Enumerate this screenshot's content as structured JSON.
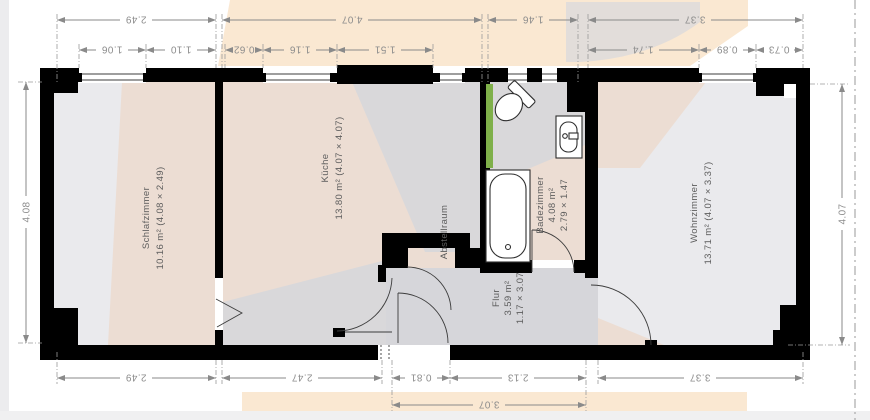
{
  "rooms": {
    "schlafzimmer": {
      "name": "Schlafzimmer",
      "detail": "10.16 m² (4.08 × 2.49)"
    },
    "kueche": {
      "name": "Küche",
      "detail": "13.80 m² (4.07 × 4.07)"
    },
    "abstellraum": {
      "name": "Abstellraum"
    },
    "badezimmer": {
      "name": "Badezimmer",
      "area": "4.08 m²",
      "size": "2.79 × 1.47"
    },
    "flur": {
      "name": "Flur",
      "area": "3.59 m²",
      "size": "1.17 × 3.07"
    },
    "wohnzimmer": {
      "name": "Wohnzimmer",
      "detail": "13.71 m² (4.07 × 3.37)"
    }
  },
  "dimensions": {
    "top_row1": [
      "2.49",
      "4.07",
      "1.46",
      "3.37"
    ],
    "top_row2": [
      "1.06",
      "1.10",
      "0.62",
      "1.16",
      "1.51",
      "1.74",
      "0.89",
      "0.73"
    ],
    "bottom_row1": [
      "2.49",
      "2.47",
      "0.81",
      "2.13",
      "3.37"
    ],
    "bottom_row2": [
      "3.07"
    ],
    "left": "4.08",
    "right": "4.07"
  },
  "colors": {
    "wall": "#000000",
    "floor_beige": "#ecddd3",
    "floor_grey": "#eaeaed",
    "flur_grey": "#d6d6da",
    "watermark_peach": "#f9e2c7",
    "watermark_grey": "#d9d9dc",
    "window_heater_green": "#7fb04a",
    "dimension_grey": "#8c8c8c"
  }
}
